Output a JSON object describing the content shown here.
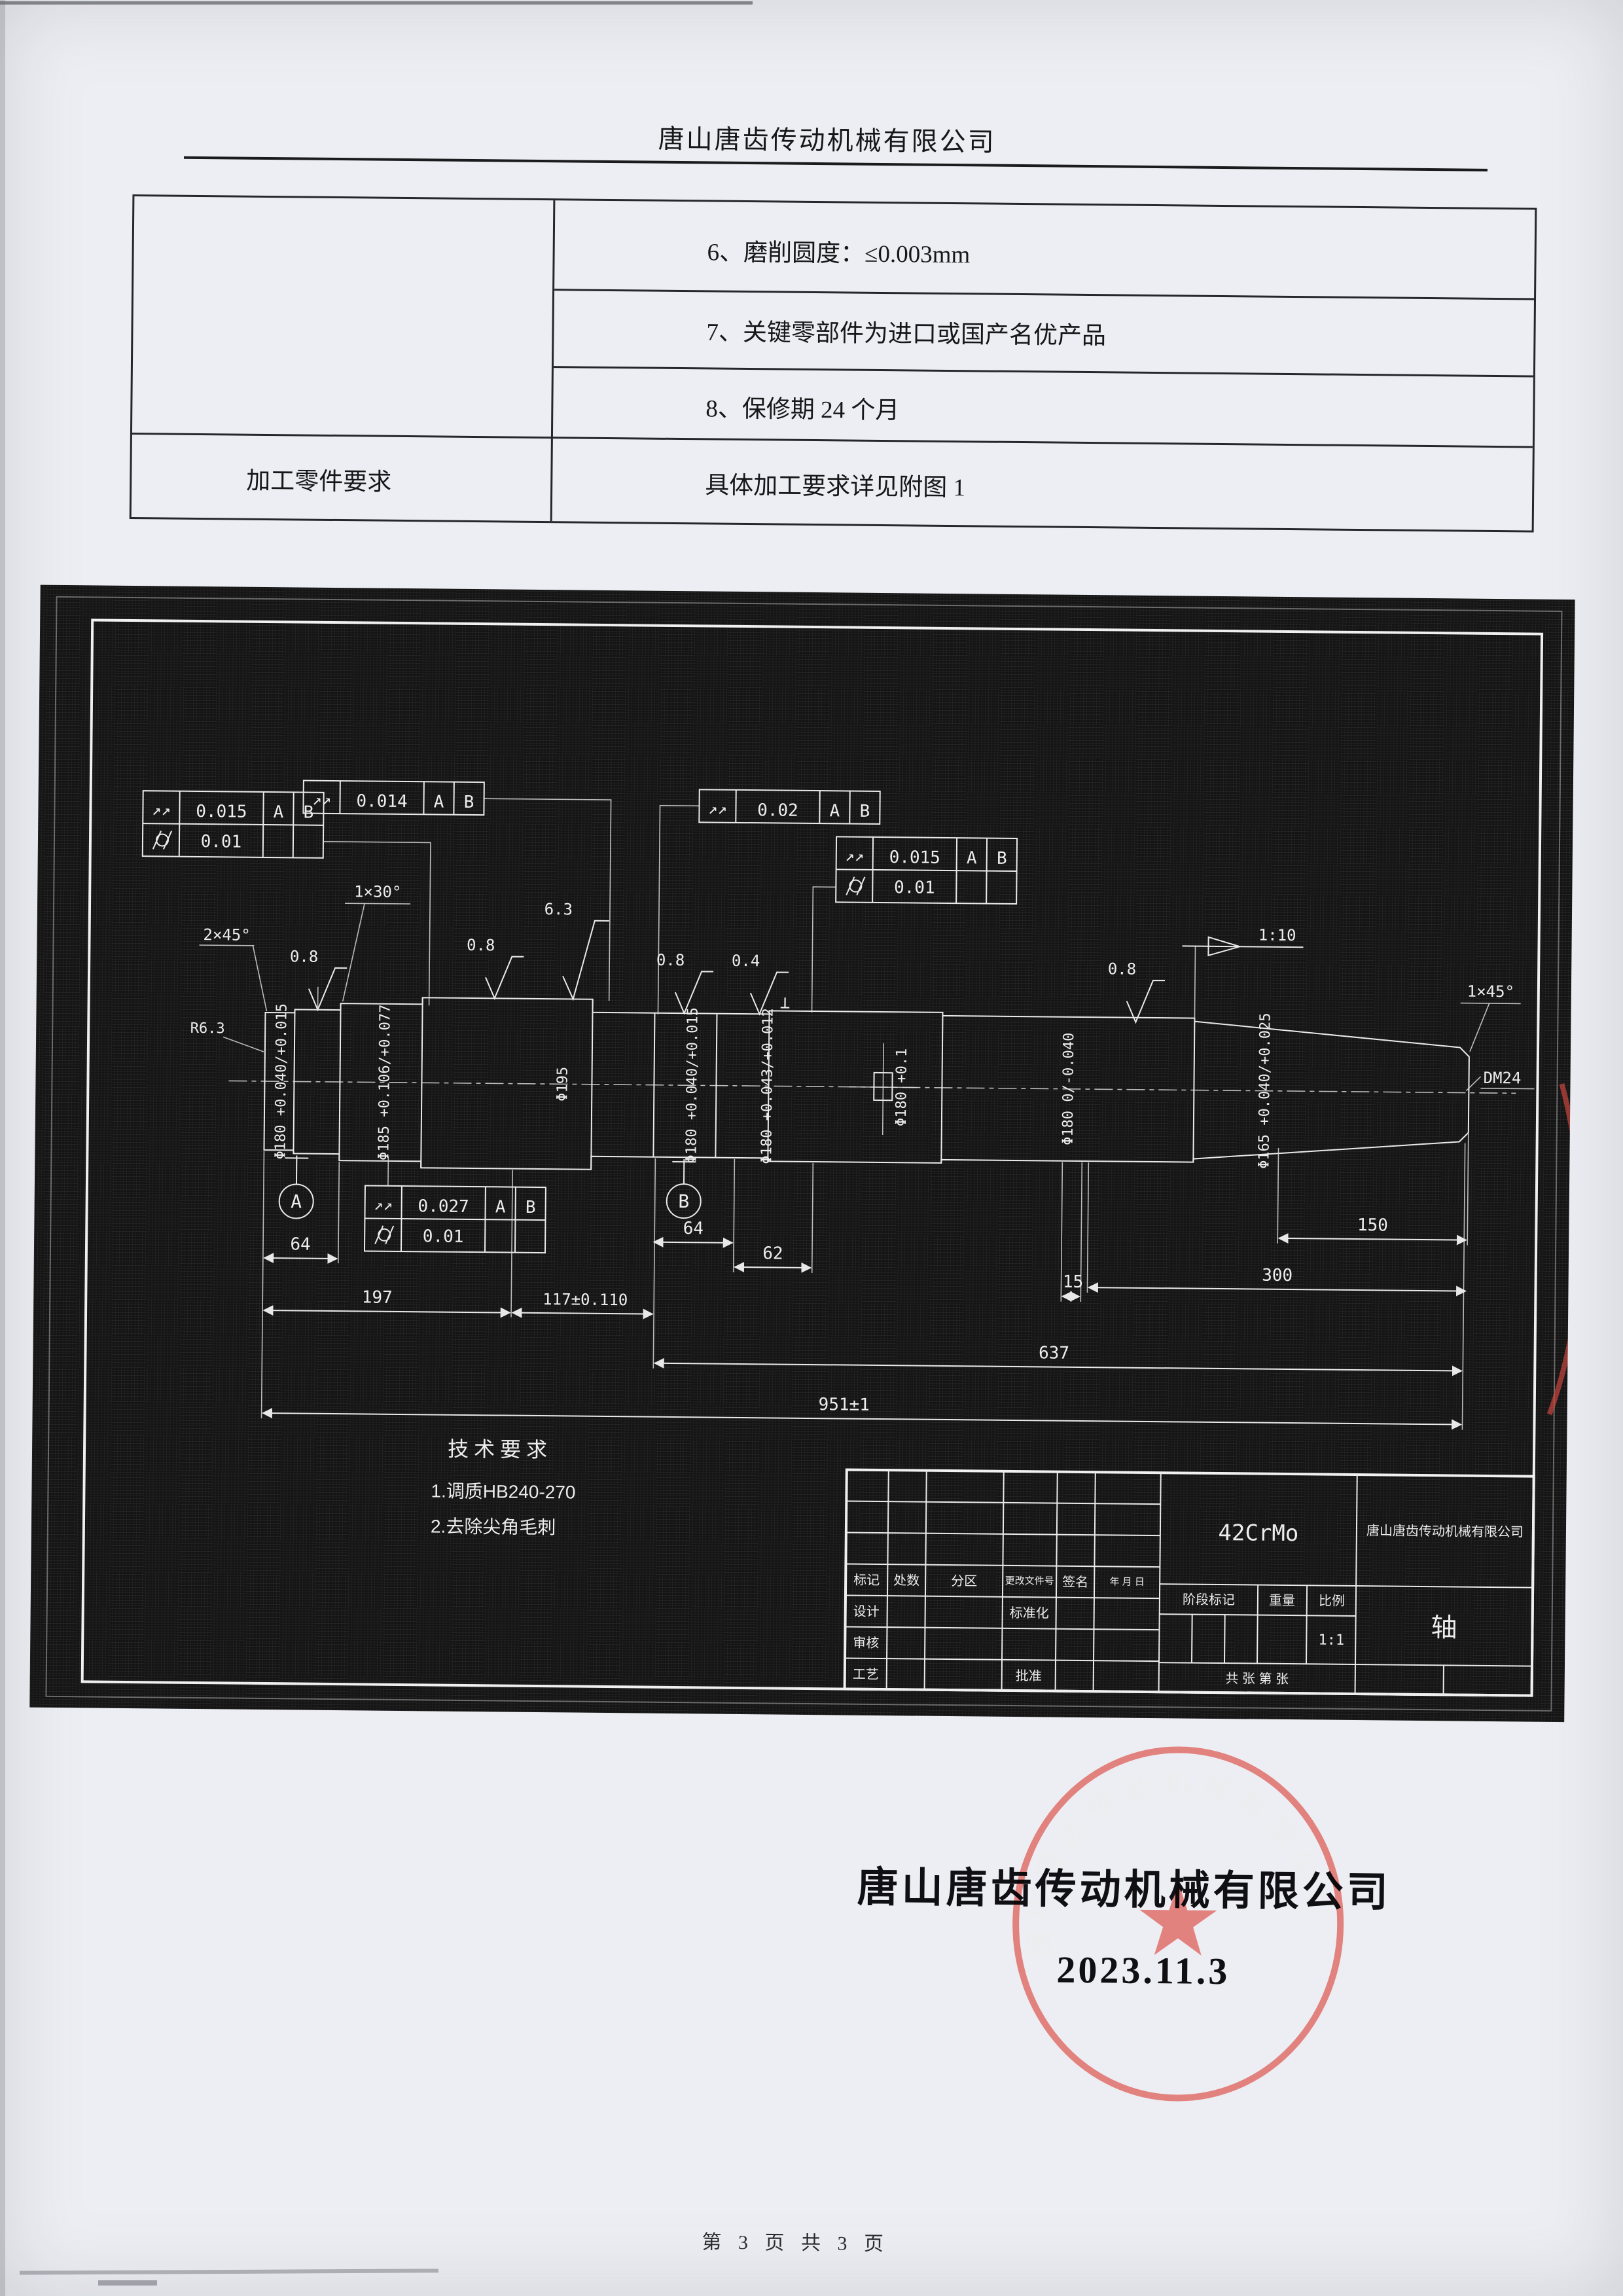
{
  "page": {
    "footer": "第 3 页 共 3 页"
  },
  "header": {
    "company": "唐山唐齿传动机械有限公司"
  },
  "spec_table": {
    "row6": "6、磨削圆度：≤0.003mm",
    "row7": "7、关键零部件为进口或国产名优产品",
    "row8": "8、保修期 24 个月",
    "left_label": "加工零件要求",
    "row9_right": "具体加工要求详见附图 1"
  },
  "drawing": {
    "icons": {
      "total_runout": "↗↗",
      "perpendicularity": "⊥"
    },
    "fcf_a": {
      "val1": "0.015",
      "d1": "A",
      "d2": "B",
      "val2": "0.01"
    },
    "fcf_b": {
      "val": "0.014",
      "d1": "A",
      "d2": "B"
    },
    "fcf_c": {
      "val": "0.02",
      "d1": "A",
      "d2": "B"
    },
    "fcf_d": {
      "val1": "0.015",
      "d1": "A",
      "d2": "B",
      "val2": "0.01"
    },
    "fcf_e": {
      "val1": "0.027",
      "d1": "A",
      "d2": "B",
      "val2": "0.01"
    },
    "surface": {
      "f1": "0.8",
      "f2": "0.8",
      "f3": "6.3",
      "f4": "0.8",
      "f5": "0.4",
      "f6": "0.8"
    },
    "chamfer_left": "2×45°",
    "chamfer_mid": "1×30°",
    "chamfer_right": "1×45°",
    "taper": "1:10",
    "fillet": "R6.3",
    "center_hole": "DM24",
    "datum_a": "A",
    "datum_b": "B",
    "dia": {
      "d1": "Φ180 +0.040/+0.015",
      "d2": "Φ185 +0.106/+0.077",
      "d3": "Φ195",
      "d4": "Φ180 +0.040/+0.015",
      "d5": "Φ180 +0.043/+0.012",
      "d6": "Φ180 +0.1",
      "d7": "Φ180 0/-0.040",
      "d8": "Φ165 +0.040/+0.025"
    },
    "dim": {
      "l64a": "64",
      "l64b": "64",
      "l62": "62",
      "l15": "15",
      "l150": "150",
      "l300": "300",
      "l197": "197",
      "l117": "117±0.110",
      "l637": "637",
      "l951": "951±1"
    },
    "tech": {
      "title": "技术要求",
      "i1": "1.调质HB240-270",
      "i2": "2.去除尖角毛刺"
    }
  },
  "title_block": {
    "material": "42CrMo",
    "company": "唐山唐齿传动机械有限公司",
    "part": "轴",
    "scale_val": "1:1",
    "sheet": "共  张  第  张",
    "lbl": {
      "mark": "标记",
      "count": "处数",
      "zone": "分区",
      "file_no": "更改文件号",
      "sign": "签名",
      "ymd": "年 月 日",
      "design": "设计",
      "std": "标准化",
      "check": "审核",
      "craft": "工艺",
      "approve": "批准",
      "stage": "阶段标记",
      "weight": "重量",
      "scale": "比例"
    }
  },
  "signature": {
    "company": "唐山唐齿传动机械有限公司",
    "date": "2023.11.3"
  },
  "stamp": {
    "ring_text": "唐山唐齿传动机械有限公司",
    "color": "#d94d45"
  }
}
